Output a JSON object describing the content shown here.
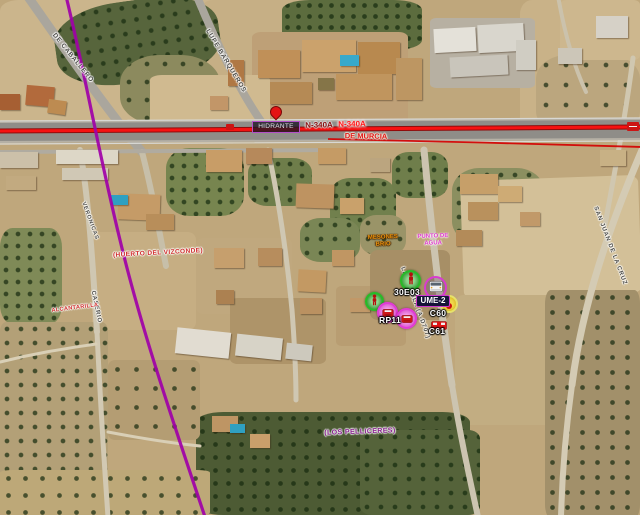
{
  "map": {
    "route_labels": {
      "n340a_dark": "N-340A",
      "n340a_bright": "N-340A",
      "de_murcia": "DE MURCIA"
    },
    "street_labels": [
      {
        "id": "de-caballero",
        "text": "DE CABALLERO"
      },
      {
        "id": "lupe-barqueros",
        "text": "LUPE BARQUEROS"
      },
      {
        "id": "veronicas",
        "text": "VERONICAS"
      },
      {
        "id": "caserio",
        "text": "CASERIO"
      },
      {
        "id": "la-rambla",
        "text": "LA RAMBLA (A-D707)"
      },
      {
        "id": "san-juan-de-la-cruz",
        "text": "SAN JUAN DE LA CRUZ"
      }
    ],
    "place_labels": [
      {
        "id": "huerto-del-vizconde",
        "text": "(HUERTO DEL VIZCONDE)"
      },
      {
        "id": "alcantarilla",
        "text": "ALCANTARILLA"
      },
      {
        "id": "los-pelliceres",
        "text": "(LOS PELLICERES)"
      }
    ],
    "poi": {
      "hidrante": "HIDRANTE",
      "punto_agua_line1": "PUNTO DE",
      "punto_agua_line2": "AGUA",
      "orange_line1": "MESONES",
      "orange_line2": "BRIO"
    },
    "units": [
      {
        "id": "30E03",
        "label": "30E03",
        "type": "personnel"
      },
      {
        "id": "UME-2",
        "label": "UME-2",
        "type": "vehicle"
      },
      {
        "id": "C60",
        "label": "C60",
        "type": "vehicle"
      },
      {
        "id": "C61",
        "label": "C61",
        "type": "vehicle"
      },
      {
        "id": "RP11",
        "label": "RP11",
        "type": "vehicle"
      }
    ],
    "colors": {
      "route_highlight": "#ff1212",
      "route_secondary": "#d40000",
      "pipeline_purple": "#a000a8",
      "unit_green": "#27bb27",
      "unit_magenta": "#e23ad6",
      "ume_box_border": "#cc3acc",
      "hidrante_border": "#b44fc8",
      "place_red": "#d02c2c",
      "place_purple": "#8a2090",
      "label_orange": "#e8900a",
      "label_magenta": "#e03ad0"
    }
  }
}
